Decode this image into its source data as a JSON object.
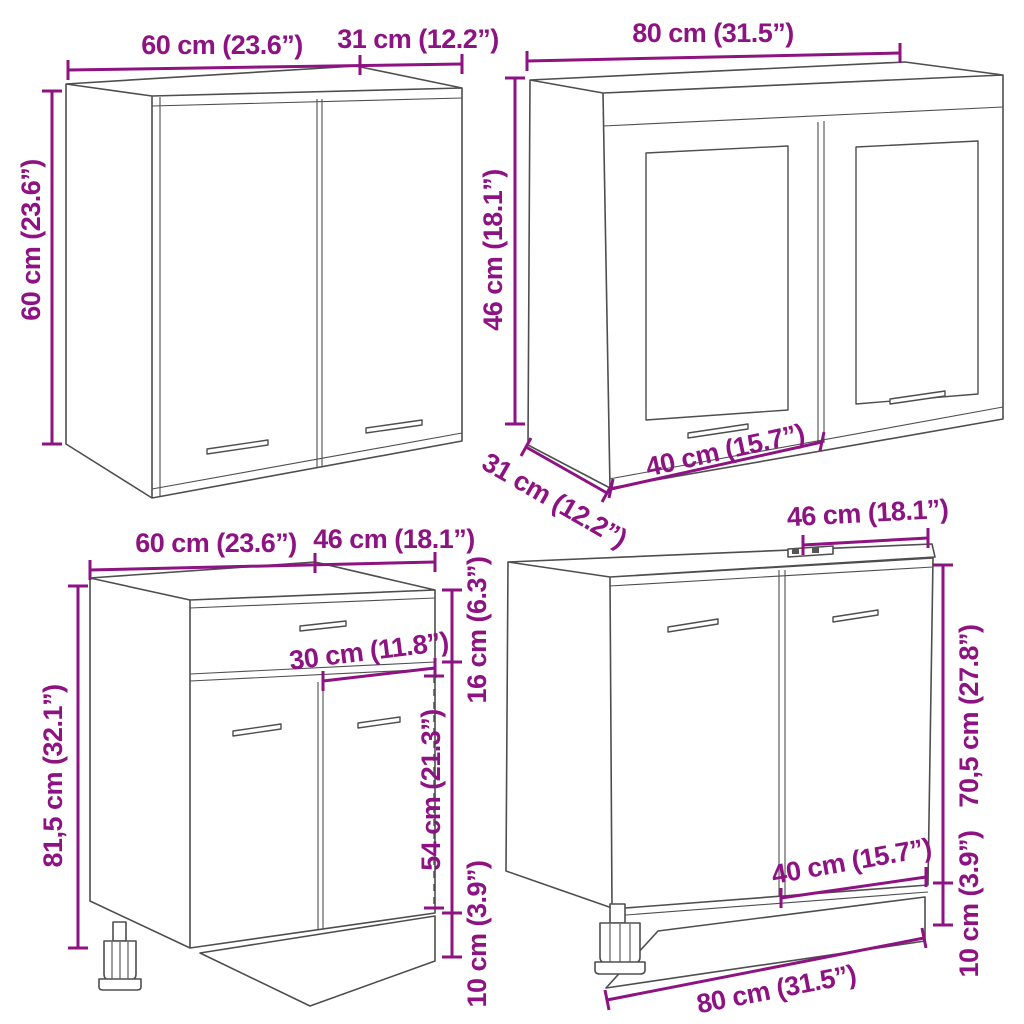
{
  "page": {
    "background": "#ffffff",
    "dimension_color": "#8D1282",
    "drawing_line_color": "#4e4e4e"
  },
  "cabinets": [
    {
      "name": "two-door wall cabinet",
      "labels": {
        "width": "60 cm (23.6”)",
        "depth": "31 cm (12.2”)",
        "height": "60 cm (23.6”)"
      }
    },
    {
      "name": "two-door glass wall cabinet",
      "labels": {
        "width": "80 cm (31.5”)",
        "height": "46 cm (18.1”)",
        "depth": "31 cm (12.2”)",
        "door_width": "40 cm (15.7”)"
      }
    },
    {
      "name": "base cabinet with drawer",
      "labels": {
        "width": "60 cm (23.6”)",
        "depth": "46 cm (18.1”)",
        "height": "81,5 cm (32.1”)",
        "drawer_width": "30 cm (11.8”)",
        "top_section_height": "16 cm (6.3”)",
        "door_height": "54 cm (21.3”)",
        "plinth_height": "10 cm (3.9”)"
      }
    },
    {
      "name": "sink base cabinet",
      "labels": {
        "depth": "46 cm (18.1”)",
        "height": "70,5 cm (27.8”)",
        "door_width": "40 cm (15.7”)",
        "plinth_height": "10 cm (3.9”)",
        "width": "80 cm (31.5”)"
      }
    }
  ]
}
